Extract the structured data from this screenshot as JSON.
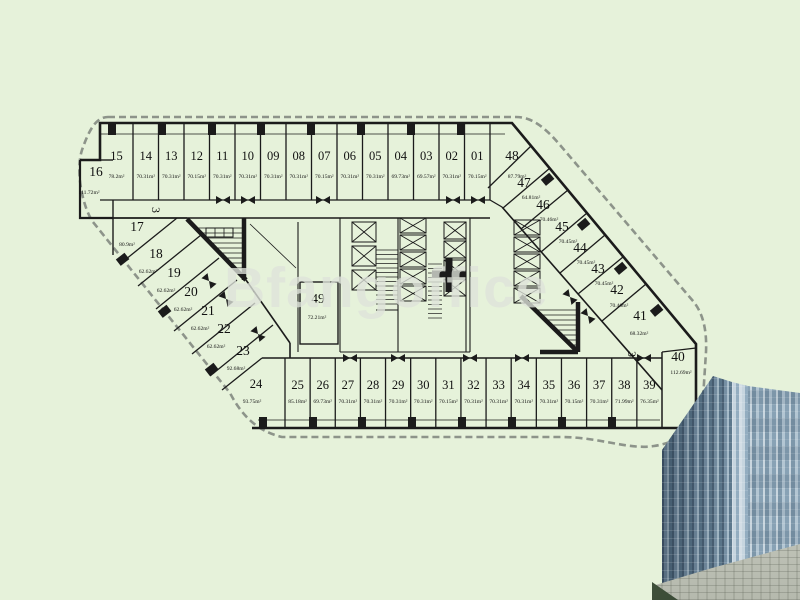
{
  "background": {
    "canvas": "#e6f2da"
  },
  "watermark": "Bfangoffice",
  "markers": {
    "left": "3",
    "right": "3"
  },
  "units": {
    "top_row": [
      {
        "no": "15",
        "area": "78.2m²"
      },
      {
        "no": "14",
        "area": "70.31m²"
      },
      {
        "no": "13",
        "area": "70.31m²"
      },
      {
        "no": "12",
        "area": "70.15m²"
      },
      {
        "no": "11",
        "area": "70.31m²"
      },
      {
        "no": "10",
        "area": "70.31m²"
      },
      {
        "no": "09",
        "area": "70.31m²"
      },
      {
        "no": "08",
        "area": "70.31m²"
      },
      {
        "no": "07",
        "area": "70.15m²"
      },
      {
        "no": "06",
        "area": "70.31m²"
      },
      {
        "no": "05",
        "area": "70.31m²"
      },
      {
        "no": "04",
        "area": "69.73m²"
      },
      {
        "no": "03",
        "area": "69.57m²"
      },
      {
        "no": "02",
        "area": "70.31m²"
      },
      {
        "no": "01",
        "area": "70.15m²"
      },
      {
        "no": "48",
        "area": "87.79m²"
      }
    ],
    "left_column": [
      {
        "no": "16",
        "area": "111.72m²"
      },
      {
        "no": "17",
        "area": "80.9m²"
      },
      {
        "no": "18",
        "area": "62.62m²"
      },
      {
        "no": "19",
        "area": "62.62m²"
      },
      {
        "no": "20",
        "area": "62.62m²"
      },
      {
        "no": "21",
        "area": "62.62m²"
      },
      {
        "no": "22",
        "area": "62.62m²"
      },
      {
        "no": "23",
        "area": "92.68m²"
      }
    ],
    "bottom_row": [
      {
        "no": "24",
        "area": "93.75m²"
      },
      {
        "no": "25",
        "area": "85.18m²"
      },
      {
        "no": "26",
        "area": "69.73m²"
      },
      {
        "no": "27",
        "area": "70.31m²"
      },
      {
        "no": "28",
        "area": "70.31m²"
      },
      {
        "no": "29",
        "area": "70.31m²"
      },
      {
        "no": "30",
        "area": "70.31m²"
      },
      {
        "no": "31",
        "area": "70.15m²"
      },
      {
        "no": "32",
        "area": "70.31m²"
      },
      {
        "no": "33",
        "area": "70.31m²"
      },
      {
        "no": "34",
        "area": "70.31m²"
      },
      {
        "no": "35",
        "area": "70.31m²"
      },
      {
        "no": "36",
        "area": "70.15m²"
      },
      {
        "no": "37",
        "area": "70.31m²"
      },
      {
        "no": "38",
        "area": "71.99m²"
      },
      {
        "no": "39",
        "area": "76.35m²"
      }
    ],
    "right_column": [
      {
        "no": "47",
        "area": "64.81m²"
      },
      {
        "no": "46",
        "area": "70.46m²"
      },
      {
        "no": "45",
        "area": "70.45m²"
      },
      {
        "no": "44",
        "area": "70.45m²"
      },
      {
        "no": "43",
        "area": "70.45m²"
      },
      {
        "no": "42",
        "area": "70.46m²"
      },
      {
        "no": "41",
        "area": "68.32m²"
      },
      {
        "no": "40",
        "area": "112.69m²"
      }
    ],
    "center": [
      {
        "no": "49",
        "area": "72.21m²"
      }
    ]
  }
}
